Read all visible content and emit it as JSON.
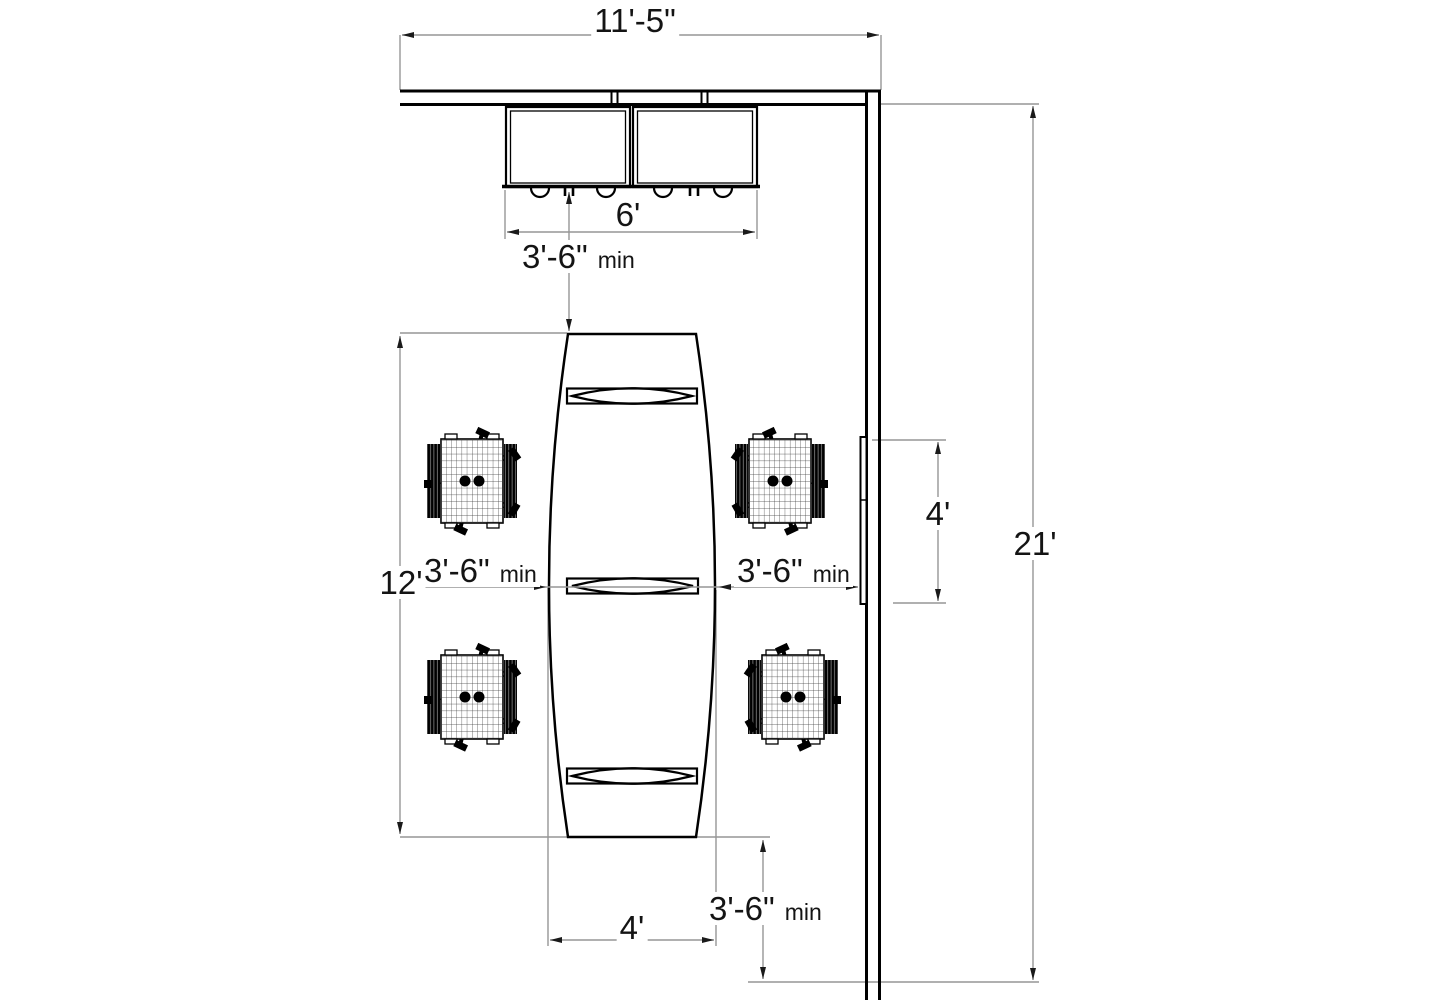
{
  "drawing": {
    "type": "furniture floor plan",
    "objects": {
      "conference_table": "boat-shaped conference table with 3 power modules",
      "chairs_count": 4,
      "wall_cabinets_count": 2,
      "wall_panel": "wall-mounted panel / marker board"
    }
  },
  "colors": {
    "background": "#ffffff",
    "object_lines": "#000000",
    "dimension_lines": "#969696",
    "arrowheads": "#1a1a1a",
    "text": "#141414"
  },
  "dimensions": {
    "room_width": {
      "value": "11'-5\""
    },
    "cabinet_run_width": {
      "value": "6'"
    },
    "clearance_cabinet_to_table": {
      "value": "3'-6\"",
      "qualifier": "min"
    },
    "table_zone_depth": {
      "value": "12'"
    },
    "clearance_left": {
      "value": "3'-6\"",
      "qualifier": "min"
    },
    "clearance_right": {
      "value": "3'-6\"",
      "qualifier": "min"
    },
    "wall_panel_length": {
      "value": "4'"
    },
    "room_depth": {
      "value": "21'"
    },
    "table_max_width": {
      "value": "4'"
    },
    "clearance_bottom": {
      "value": "3'-6\"",
      "qualifier": "min"
    }
  }
}
